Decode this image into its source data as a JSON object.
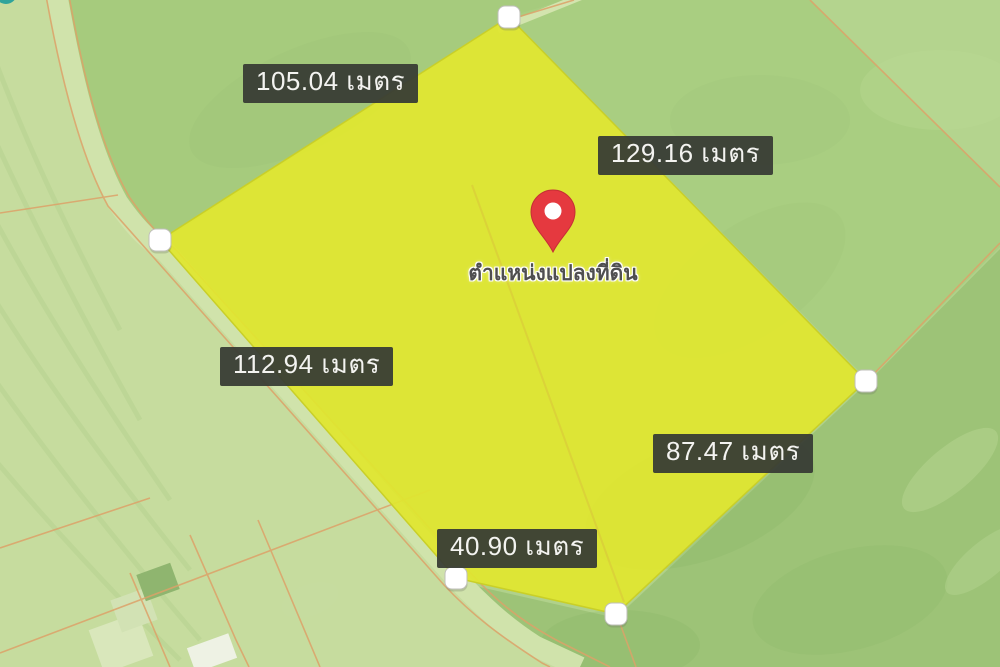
{
  "map": {
    "kind": "aerial-parcel-map",
    "plot": {
      "marker_caption": "ตำแหน่งแปลงที่ดิน",
      "unit": "เมตร",
      "vertex_count": 5,
      "measurements": [
        {
          "side": "northwest-edge",
          "label": "105.04 เมตร",
          "value": 105.04
        },
        {
          "side": "northeast-edge",
          "label": "129.16 เมตร",
          "value": 129.16
        },
        {
          "side": "west-edge",
          "label": "112.94 เมตร",
          "value": 112.94
        },
        {
          "side": "southeast-edge",
          "label": "87.47 เมตร",
          "value": 87.47
        },
        {
          "side": "south-edge",
          "label": "40.90 เมตร",
          "value": 40.9
        }
      ]
    },
    "colors": {
      "plot_fill": "#e0e62f",
      "plot_stroke": "#c9cf28",
      "label_background": "#373b34",
      "label_text": "#f3f3f0",
      "pin_red": "#e5393f",
      "map_base_green": "#b0d18b",
      "parcel_line_orange": "#dda269",
      "road_pale_green": "#d0e3ab"
    }
  }
}
